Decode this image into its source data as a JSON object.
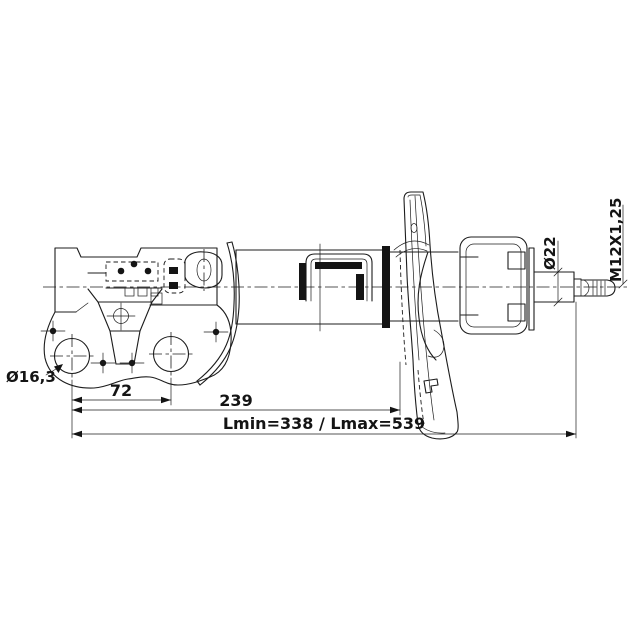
{
  "drawing": {
    "background": "#ffffff",
    "line_color": "#1c1c1c",
    "labels": {
      "hole_diameter": "Ø16,3",
      "hole_spacing": "72",
      "mount_to_seat": "239",
      "length_range": "Lmin=338 / Lmax=539",
      "rod_diameter": "Ø22",
      "thread_spec": "M12X1,25"
    }
  }
}
